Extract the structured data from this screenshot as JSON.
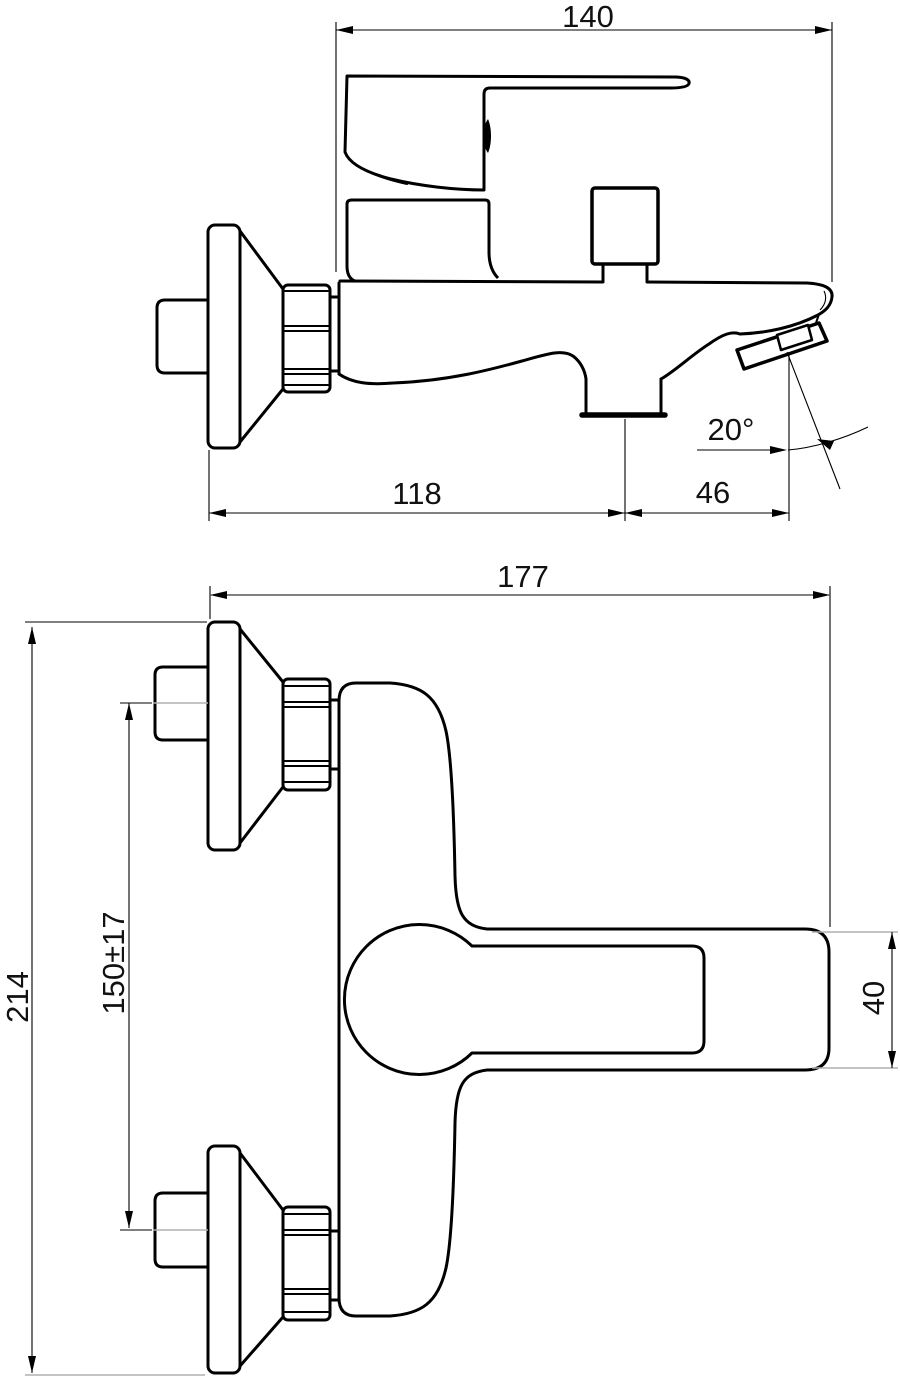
{
  "drawing": {
    "background_color": "#ffffff",
    "line_color": "#000000",
    "views": {
      "side": {
        "dim_overall_length": "140",
        "dim_wall_to_outlet": "118",
        "dim_outlet_to_spout": "46",
        "dim_spout_angle": "20°"
      },
      "plan": {
        "dim_overall_depth": "177",
        "dim_overall_width": "214",
        "dim_connection_spacing": "150±17",
        "dim_spout_width": "40"
      }
    }
  }
}
